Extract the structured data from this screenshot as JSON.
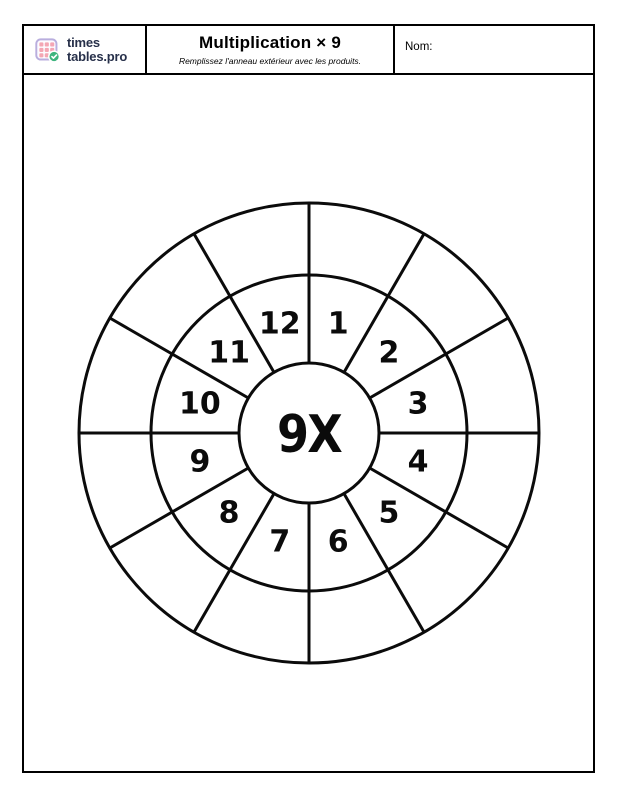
{
  "header": {
    "brand": {
      "logo_icon": "timestables-grid-check-icon",
      "name_line1": "times",
      "name_line2": "tables.pro"
    },
    "title": "Multiplication × 9",
    "subtitle": "Remplissez l'anneau extérieur avec les produits.",
    "name_label": "Nom:"
  },
  "wheel": {
    "center_label": "9X",
    "multiplier": 9,
    "sectors": 12,
    "inner_numbers": [
      "1",
      "2",
      "3",
      "4",
      "5",
      "6",
      "7",
      "8",
      "9",
      "10",
      "11",
      "12"
    ],
    "outer_values": [
      "",
      "",
      "",
      "",
      "",
      "",
      "",
      "",
      "",
      "",
      "",
      ""
    ]
  },
  "colors": {
    "line": "#0b0b0b",
    "logo_pink": "#f4a6b4",
    "logo_purple": "#b9aede",
    "logo_green": "#3db47e",
    "logo_text": "#27304a"
  }
}
